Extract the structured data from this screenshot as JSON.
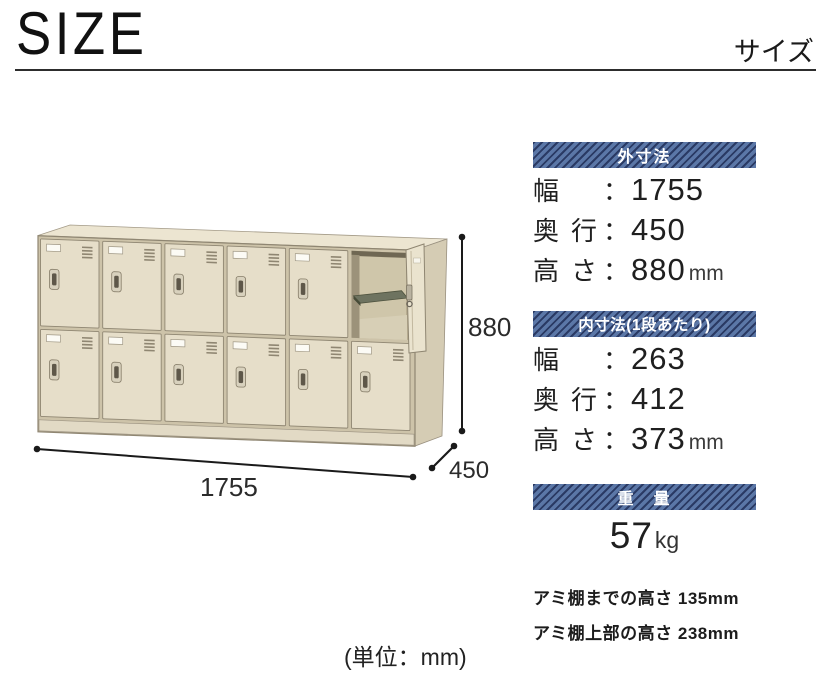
{
  "header": {
    "title": "SIZE",
    "subtitle": "サイズ"
  },
  "strings": {
    "colon": "："
  },
  "diagram": {
    "height_label": "880",
    "width_label": "1755",
    "depth_label": "450",
    "unit_note": "(単位：mm)"
  },
  "locker": {
    "rows": 2,
    "cols": 6,
    "open_cell": {
      "row": 0,
      "col": 5
    }
  },
  "panels": [
    {
      "heading": "外寸法",
      "rows": [
        {
          "label": "幅",
          "value": "1755"
        },
        {
          "label": "奥行",
          "value": "450"
        },
        {
          "label": "高さ",
          "value": "880",
          "unit": "mm"
        }
      ]
    },
    {
      "heading": "内寸法(1段あたり)",
      "rows": [
        {
          "label": "幅",
          "value": "263"
        },
        {
          "label": "奥行",
          "value": "412"
        },
        {
          "label": "高さ",
          "value": "373",
          "unit": "mm"
        }
      ]
    },
    {
      "heading": "重　量",
      "value": "57",
      "unit": "kg"
    }
  ],
  "notes": [
    "アミ棚までの高さ 135mm",
    "アミ棚上部の高さ 238mm"
  ],
  "colors": {
    "band_base": "#5b77a7",
    "band_stripe": "#2a3a64",
    "band_text": "#ffffff",
    "text": "#1f1f1f",
    "locker_body": "#e6dec9",
    "locker_frame": "#8f8672",
    "locker_side": "#d5ccb4",
    "locker_top": "#ece5d1",
    "shelf": "#6e7360",
    "dimension": "#1a1a1a"
  }
}
